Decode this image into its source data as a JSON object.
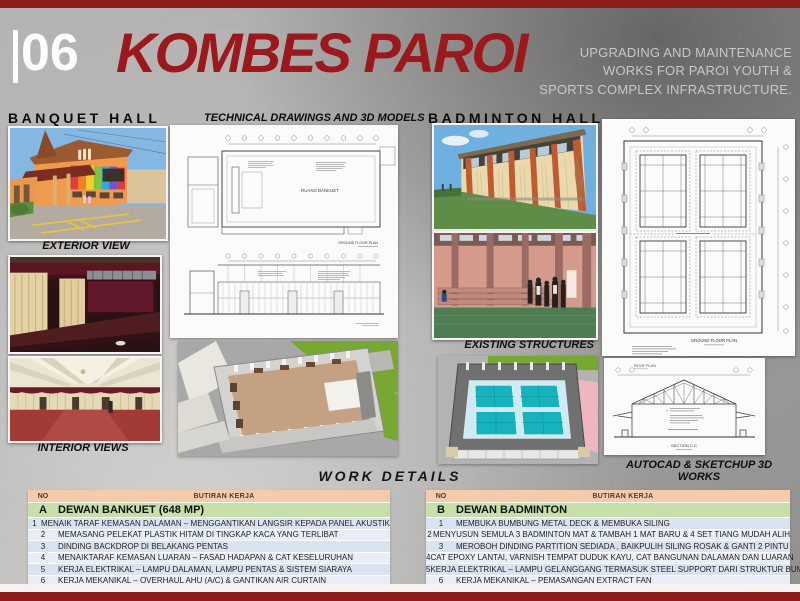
{
  "header": {
    "slide_number": "06",
    "title": "KOMBES PAROI",
    "subtitle": [
      "UPGRADING AND MAINTENANCE",
      "WORKS FOR PAROI YOUTH &",
      "SPORTS COMPLEX INFRASTRUCTURE."
    ]
  },
  "sections": {
    "banquet_heading": "BANQUET HALL",
    "technical_heading": "TECHNICAL DRAWINGS AND 3D MODELS",
    "badminton_heading": "BADMINTON HALL",
    "work_details_heading": "WORK DETAILS"
  },
  "captions": {
    "exterior_view": "EXTERIOR VIEW",
    "interior_views": "INTERIOR VIEWS",
    "existing_structures": "EXISTING STRUCTURES",
    "autocad_sketchup": "AUTOCAD & SKETCHUP 3D WORKS"
  },
  "drawings": {
    "banquet_room_label": "RUANG BANKUET",
    "ground_floor_plan": "GROUND FLOOR PLAN",
    "roof_plan": "ROOF PLAN",
    "section_cc": "SECTION C-C"
  },
  "tables": {
    "header": {
      "no": "NO",
      "butiran": "BUTIRAN KERJA"
    },
    "table_a": {
      "id": "A",
      "title": "DEWAN BANKUET  (648 MP)",
      "rows": [
        {
          "no": "1",
          "text": "MENAIK TARAF KEMASAN DALAMAN – MENGGANTIKAN LANGSIR KEPADA PANEL AKUSTIK"
        },
        {
          "no": "2",
          "text": "MEMASANG PELEKAT PLASTIK HITAM DI TINGKAP KACA YANG TERLIBAT"
        },
        {
          "no": "3",
          "text": "DINDING BACKDROP DI BELAKANG PENTAS"
        },
        {
          "no": "4",
          "text": "MENAIKTARAF KEMASAN LUARAN – FASAD HADAPAN & CAT KESELURUHAN"
        },
        {
          "no": "5",
          "text": "KERJA ELEKTRIKAL – LAMPU DALAMAN, LAMPU PENTAS & SISTEM SIARAYA"
        },
        {
          "no": "6",
          "text": "KERJA MEKANIKAL – OVERHAUL AHU (A/C) & GANTIKAN AIR CURTAIN"
        },
        {
          "no": "7",
          "text": "BAIKPULIH BIG SCREEN"
        }
      ]
    },
    "table_b": {
      "id": "B",
      "title": "DEWAN BADMINTON",
      "rows": [
        {
          "no": "1",
          "text": "MEMBUKA BUMBUNG METAL DECK & MEMBUKA SILING"
        },
        {
          "no": "2",
          "text": "MENYUSUN SEMULA 3 BADMINTON MAT & TAMBAH 1 MAT BARU & 4 SET TIANG MUDAH ALIH"
        },
        {
          "no": "3",
          "text": "MEROBOH DINDING PARTITION SEDIADA , BAIKPULIH SILING ROSAK & GANTI 2 PINTU"
        },
        {
          "no": "4",
          "text": "CAT EPOXY LANTAI, VARNISH TEMPAT DUDUK KAYU, CAT BANGUNAN DALAMAN DAN LUARAN"
        },
        {
          "no": "5",
          "text": "KERJA ELEKTRIKAL – LAMPU GELANGGANG TERMASUK STEEL SUPPORT DARI STRUKTUR BUMBUNG"
        },
        {
          "no": "6",
          "text": "KERJA MEKANIKAL – PEMASANGAN EXTRACT FAN"
        }
      ]
    }
  },
  "colors": {
    "accent_red": "#8e1c1c",
    "title_red": "#9b191c",
    "table_header_bg": "#f6cbac",
    "table_section_bg": "#c7dfa9",
    "row_alt_dark": "#dae3f1",
    "row_alt_light": "#e9edf6"
  }
}
